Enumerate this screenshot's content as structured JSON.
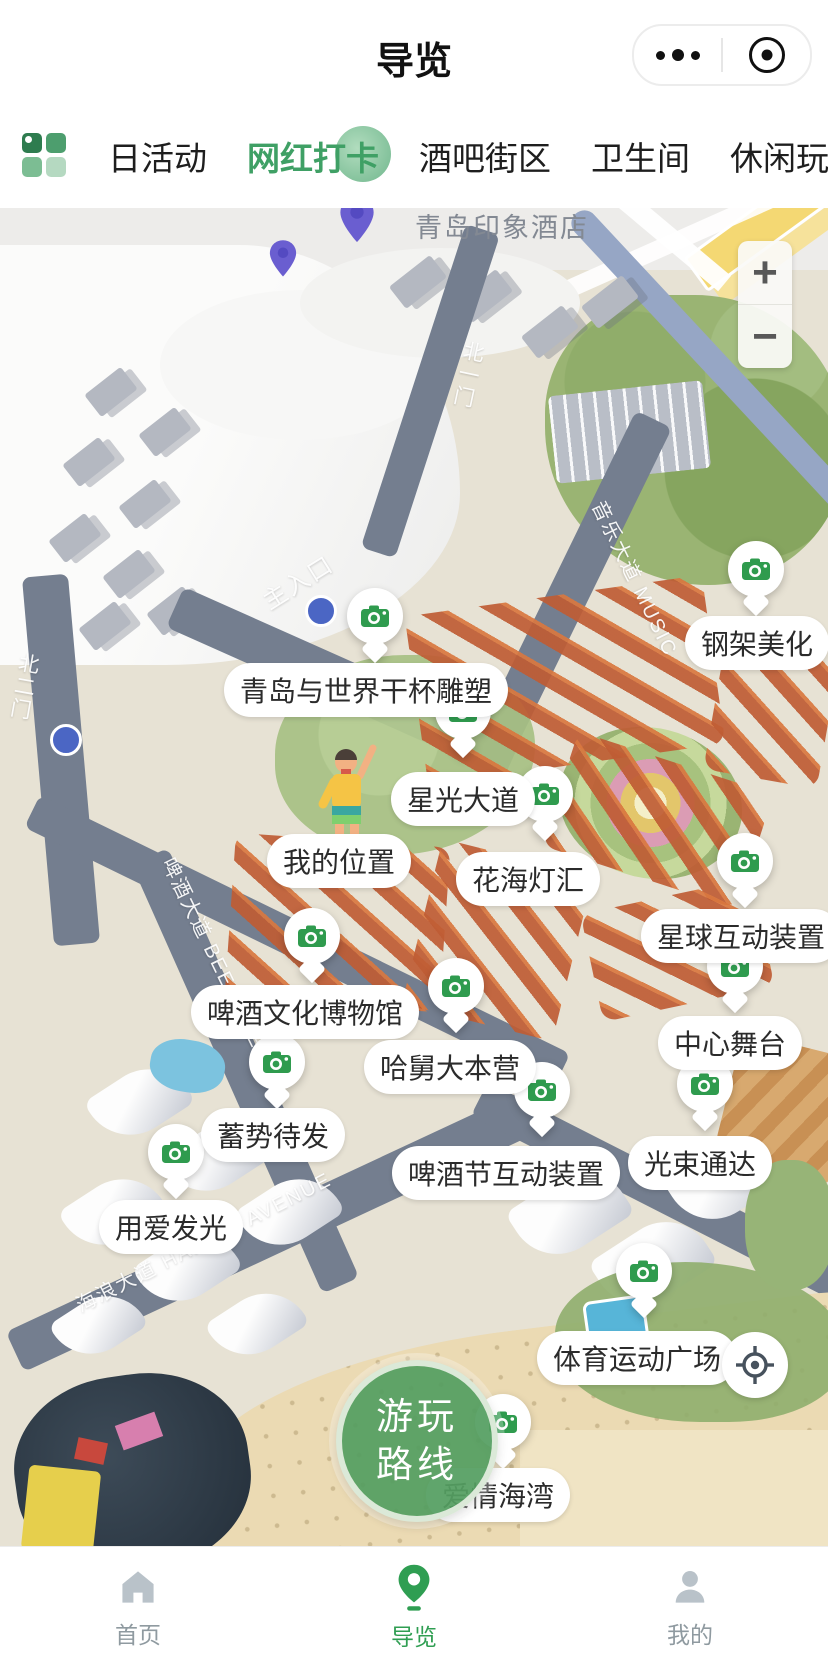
{
  "header": {
    "title": "导览"
  },
  "category_bar": {
    "tabs": [
      "日活动",
      "网红打卡",
      "酒吧街区",
      "卫生间",
      "休闲玩乐"
    ],
    "active_index": 1
  },
  "base_map": {
    "hotel_label": "青岛印象酒店"
  },
  "zoom_control": {
    "zoom_in": "+",
    "zoom_out": "−"
  },
  "road_labels": [
    {
      "text": "主入口"
    },
    {
      "text": "北一门"
    },
    {
      "text": "北二门"
    },
    {
      "text": "音乐大道 MUSIC"
    },
    {
      "text": "啤酒大道 BEER AVENUE"
    },
    {
      "text": "海浪大道 HAIHUN AVENUE"
    }
  ],
  "pois": [
    {
      "id": "gangjia-meihua",
      "name": "钢架美化",
      "pin": {
        "x": 756,
        "y": 615
      },
      "label": {
        "x": 757,
        "y": 643
      }
    },
    {
      "id": "ganbei-diaosu",
      "name": "青岛与世界干杯雕塑",
      "pin": {
        "x": 375,
        "y": 662
      },
      "label": {
        "x": 366,
        "y": 690
      }
    },
    {
      "id": "xingguang-dadao",
      "name": "星光大道",
      "pin": {
        "x": 463,
        "y": 757
      },
      "label": {
        "x": 463,
        "y": 799
      }
    },
    {
      "id": "huahai-denghui",
      "name": "花海灯汇",
      "pin": {
        "x": 545,
        "y": 840
      },
      "label": {
        "x": 528,
        "y": 879
      }
    },
    {
      "id": "xingqiu-hudong",
      "name": "星球互动装置",
      "pin": {
        "x": 745,
        "y": 907
      },
      "label": {
        "x": 741,
        "y": 936
      }
    },
    {
      "id": "pijiu-bowuguan",
      "name": "啤酒文化博物馆",
      "pin": {
        "x": 312,
        "y": 982
      },
      "label": {
        "x": 305,
        "y": 1012
      }
    },
    {
      "id": "zhongxin-wutai",
      "name": "中心舞台",
      "pin": {
        "x": 735,
        "y": 1012
      },
      "label": {
        "x": 730,
        "y": 1043
      }
    },
    {
      "id": "hajiu-dabenying",
      "name": "哈舅大本营",
      "pin": {
        "x": 456,
        "y": 1032
      },
      "label": {
        "x": 450,
        "y": 1067
      }
    },
    {
      "id": "xushi-daifa",
      "name": "蓄势待发",
      "pin": {
        "x": 277,
        "y": 1108
      },
      "label": {
        "x": 273,
        "y": 1135
      }
    },
    {
      "id": "guangshu-tongda",
      "name": "光束通达",
      "pin": {
        "x": 705,
        "y": 1130
      },
      "label": {
        "x": 700,
        "y": 1163
      }
    },
    {
      "id": "pijiujie-hudong",
      "name": "啤酒节互动装置",
      "pin": {
        "x": 542,
        "y": 1136
      },
      "label": {
        "x": 506,
        "y": 1173
      }
    },
    {
      "id": "yongai-faguang",
      "name": "用爱发光",
      "pin": {
        "x": 176,
        "y": 1198
      },
      "label": {
        "x": 171,
        "y": 1227
      }
    },
    {
      "id": "tiyu-guangchang",
      "name": "体育运动广场",
      "pin": {
        "x": 644,
        "y": 1317
      },
      "label": {
        "x": 637,
        "y": 1358
      }
    },
    {
      "id": "aiqing-haiwan",
      "name": "爱情海湾",
      "pin": {
        "x": 503,
        "y": 1468
      },
      "label": {
        "x": 498,
        "y": 1495
      }
    }
  ],
  "my_location": {
    "label": "我的位置",
    "x": 339,
    "y": 861
  },
  "route_button": {
    "line1": "游玩",
    "line2": "路线"
  },
  "bottom_nav": {
    "items": [
      {
        "id": "home",
        "label": "首页"
      },
      {
        "id": "guide",
        "label": "导览"
      },
      {
        "id": "mine",
        "label": "我的"
      }
    ],
    "active_index": 1
  },
  "colors": {
    "accent_green": "#2f9e52",
    "camera_green": "#2f9b4e",
    "tab_active_green": "#3fa065",
    "purple_pin": "#6a5ed0",
    "nav_inactive": "#b9c2c9"
  }
}
